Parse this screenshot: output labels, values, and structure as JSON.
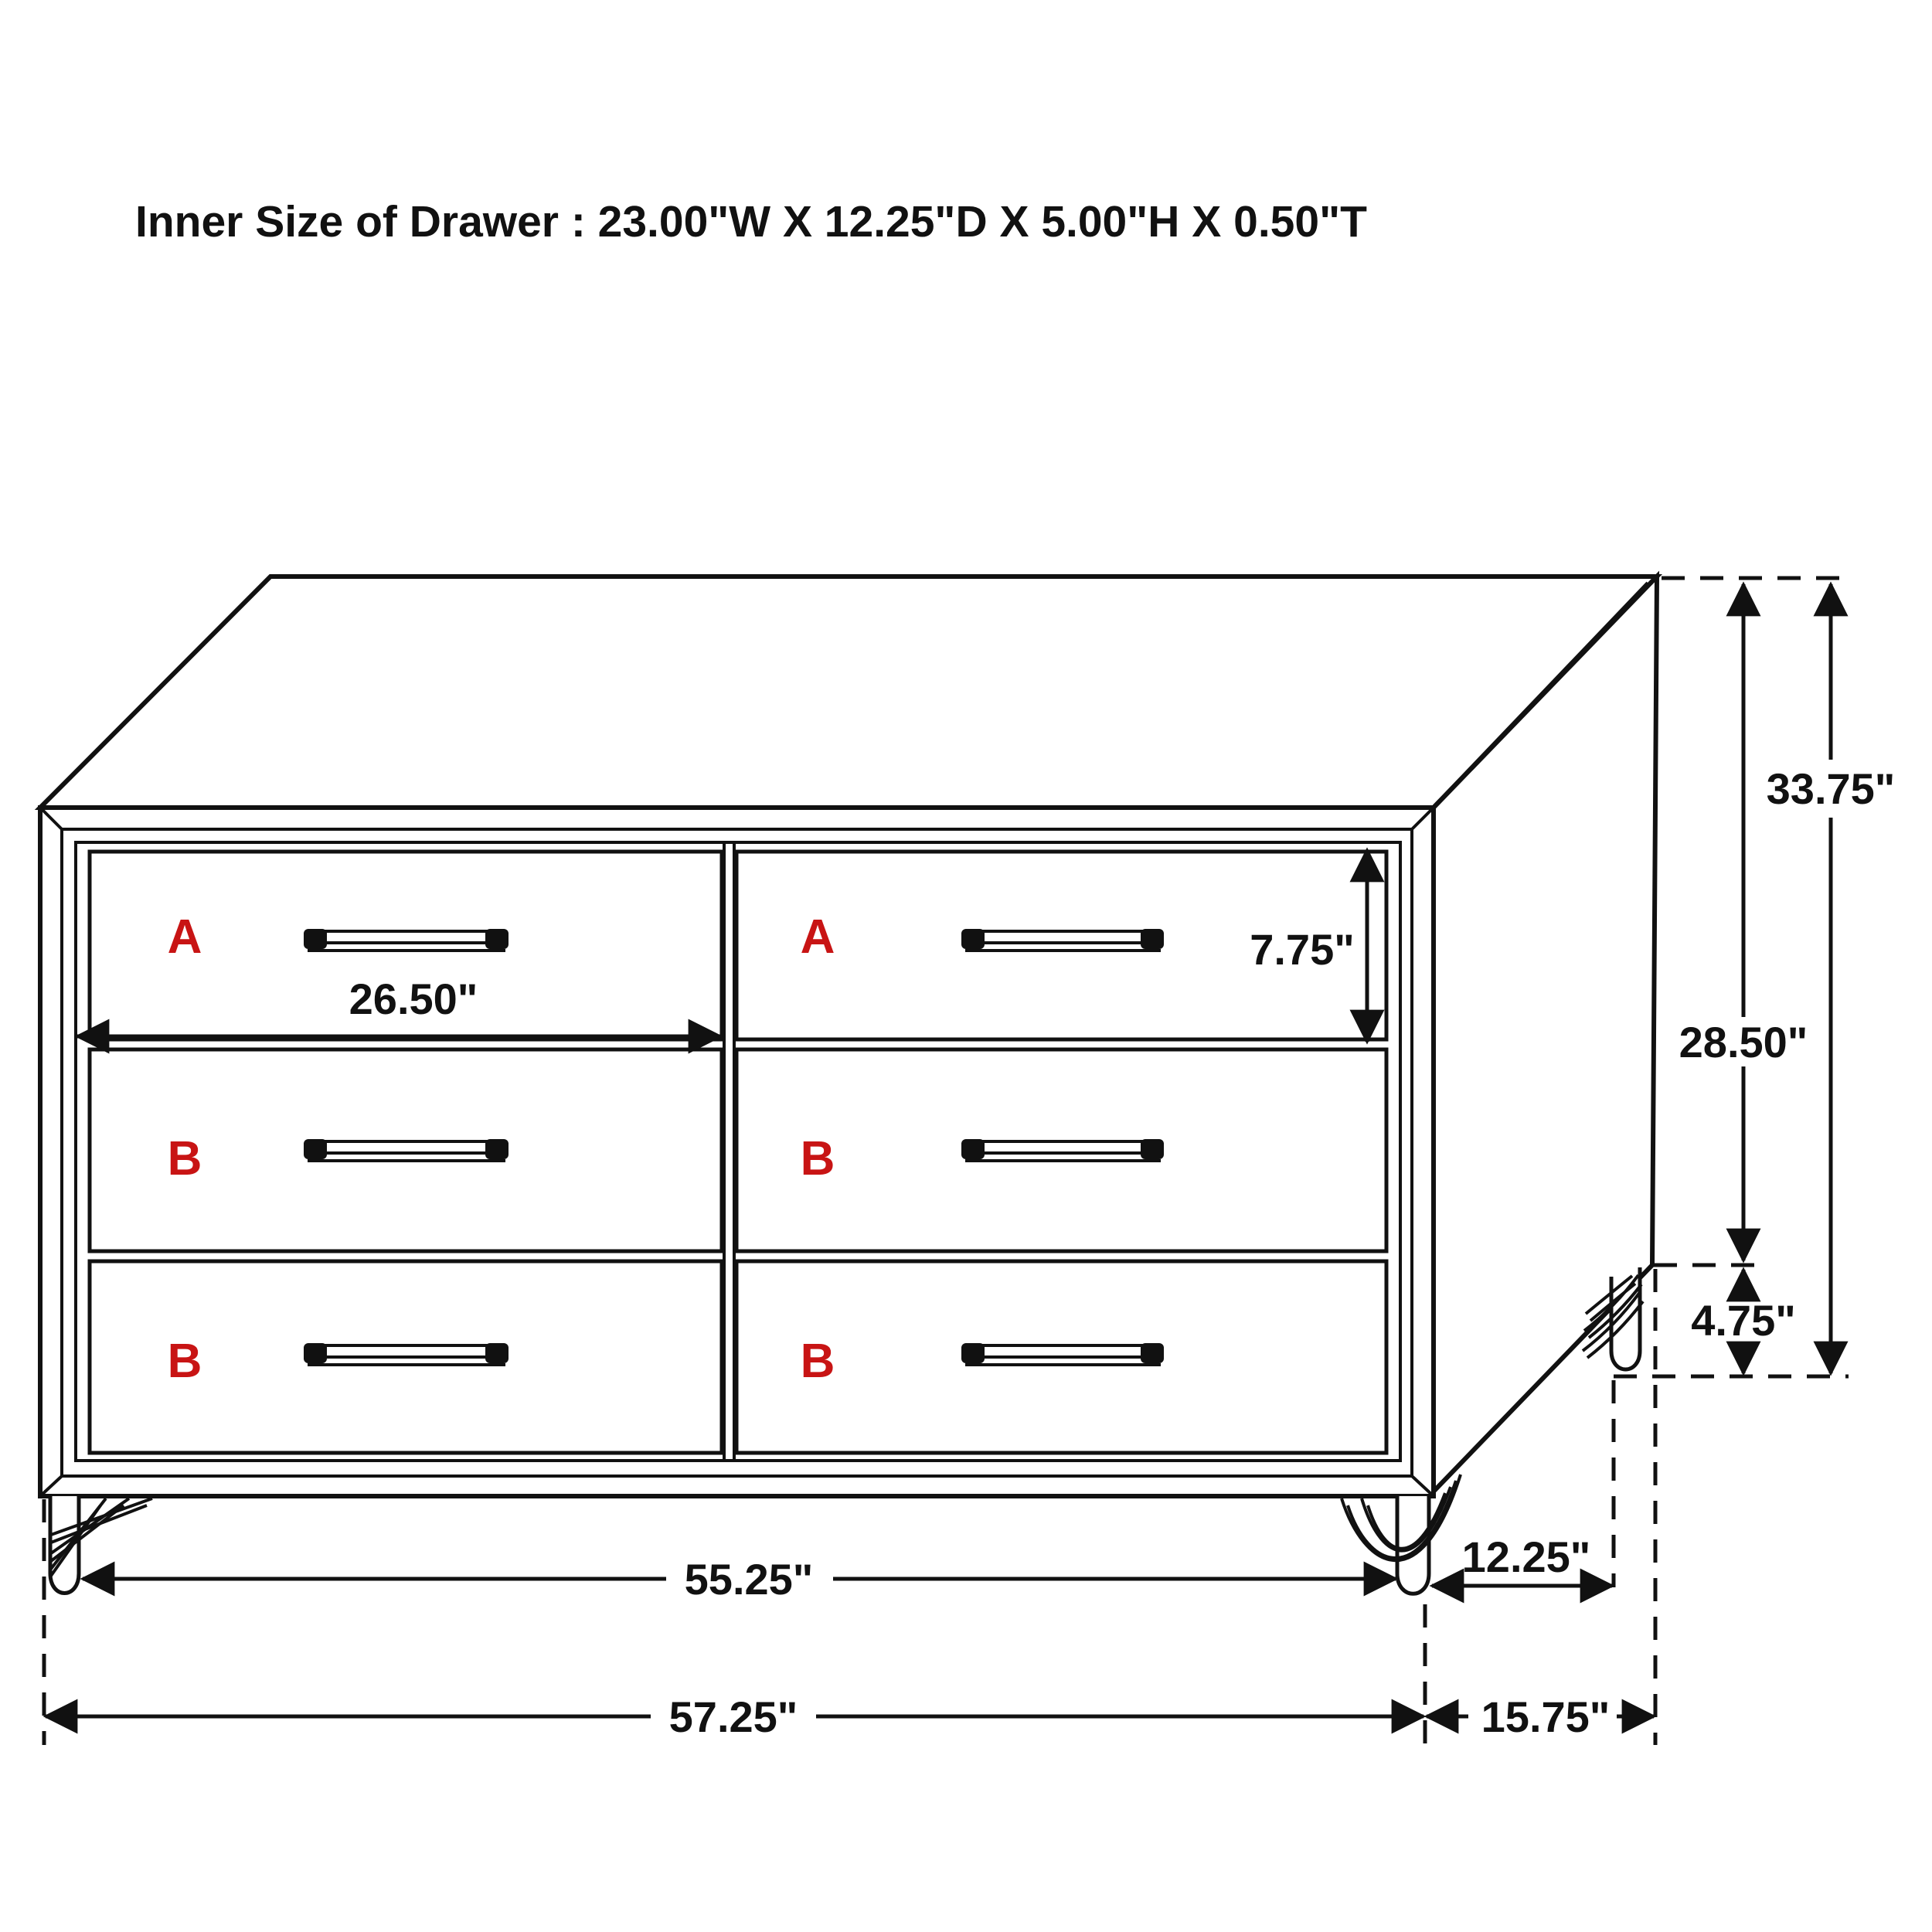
{
  "title": "Inner Size of Drawer : 23.00\"W X 12.25\"D X 5.00\"H X 0.50\"T",
  "colors": {
    "line": "#111111",
    "drawer_letter": "#c81414",
    "background": "#ffffff"
  },
  "drawers": [
    {
      "position": "top-left",
      "label": "A"
    },
    {
      "position": "top-right",
      "label": "A"
    },
    {
      "position": "middle-left",
      "label": "B"
    },
    {
      "position": "middle-right",
      "label": "B"
    },
    {
      "position": "bottom-left",
      "label": "B"
    },
    {
      "position": "bottom-right",
      "label": "B"
    }
  ],
  "dimensions": {
    "drawer_front_width": "26.50\"",
    "drawer_front_height": "7.75\"",
    "overall_height": "33.75\"",
    "case_height": "28.50\"",
    "leg_height": "4.75\"",
    "width_between_legs": "55.25\"",
    "depth_between_legs": "12.25\"",
    "overall_width": "57.25\"",
    "overall_depth": "15.75\""
  }
}
